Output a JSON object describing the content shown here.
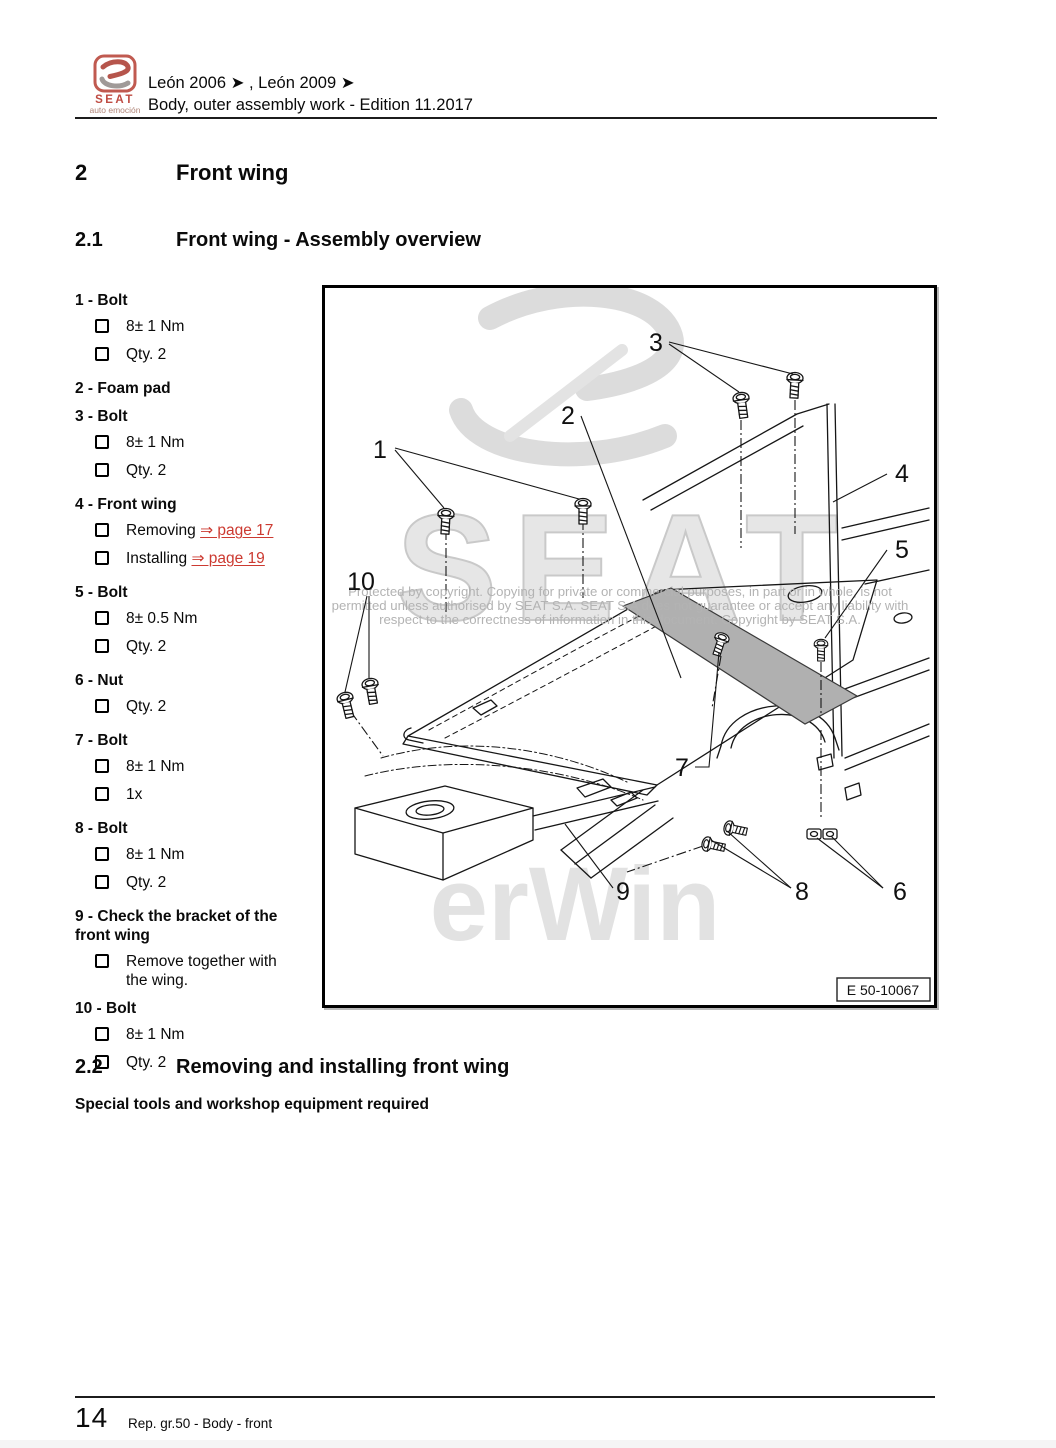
{
  "header": {
    "logo": {
      "brand": "SEAT",
      "tagline": "auto emoción"
    },
    "line1": "León 2006 ➤ , León 2009 ➤",
    "line2": "Body, outer assembly work - Edition 11.2017"
  },
  "sections": {
    "s2": {
      "number": "2",
      "title": "Front wing"
    },
    "s21": {
      "number": "2.1",
      "title": "Front wing - Assembly overview"
    },
    "s22": {
      "number": "2.2",
      "title": "Removing and installing front wing"
    }
  },
  "subheading": "Special tools and workshop equipment required",
  "parts": [
    {
      "title": "1 - Bolt",
      "details": [
        {
          "text": "8± 1 Nm"
        },
        {
          "text": "Qty. 2"
        }
      ]
    },
    {
      "title": "2 - Foam pad",
      "details": []
    },
    {
      "title": "3 - Bolt",
      "details": [
        {
          "text": "8± 1 Nm"
        },
        {
          "text": "Qty. 2"
        }
      ]
    },
    {
      "title": "4 - Front wing",
      "details": [
        {
          "text": "Removing",
          "link": "⇒ page 17"
        },
        {
          "text": "Installing",
          "link": "⇒ page 19"
        }
      ]
    },
    {
      "title": "5 - Bolt",
      "details": [
        {
          "text": "8± 0.5 Nm"
        },
        {
          "text": "Qty. 2"
        }
      ]
    },
    {
      "title": "6 - Nut",
      "details": [
        {
          "text": "Qty. 2"
        }
      ]
    },
    {
      "title": "7 - Bolt",
      "details": [
        {
          "text": "8± 1 Nm"
        },
        {
          "text": "1x"
        }
      ]
    },
    {
      "title": "8 - Bolt",
      "details": [
        {
          "text": "8± 1 Nm"
        },
        {
          "text": "Qty. 2"
        }
      ]
    },
    {
      "title": "9 - Check the bracket of the front wing",
      "details": [
        {
          "text": "Remove together with the wing."
        }
      ]
    },
    {
      "title": "10 - Bolt",
      "details": [
        {
          "text": "8± 1 Nm"
        },
        {
          "text": "Qty. 2"
        }
      ]
    }
  ],
  "figure": {
    "watermark": {
      "brand": "SEAT",
      "partial": "erWin"
    },
    "copyright_lines": [
      "Protected by copyright. Copying for private or commercial purposes, in part or in whole, is not",
      "permitted unless authorised by SEAT S.A. SEAT S.A does not guarantee or accept any liability with",
      "respect to the correctness of information in this document. Copyright by SEAT S.A."
    ],
    "callouts": [
      "1",
      "2",
      "3",
      "4",
      "5",
      "6",
      "7",
      "8",
      "9",
      "10"
    ],
    "label": "E 50-10067"
  },
  "footer": {
    "page_number": "14",
    "caption": "Rep. gr.50 - Body - front"
  },
  "colors": {
    "link_red": "#cc3a31",
    "brand_red": "#bf4b42",
    "watermark_gray": "#d9d9d9"
  }
}
